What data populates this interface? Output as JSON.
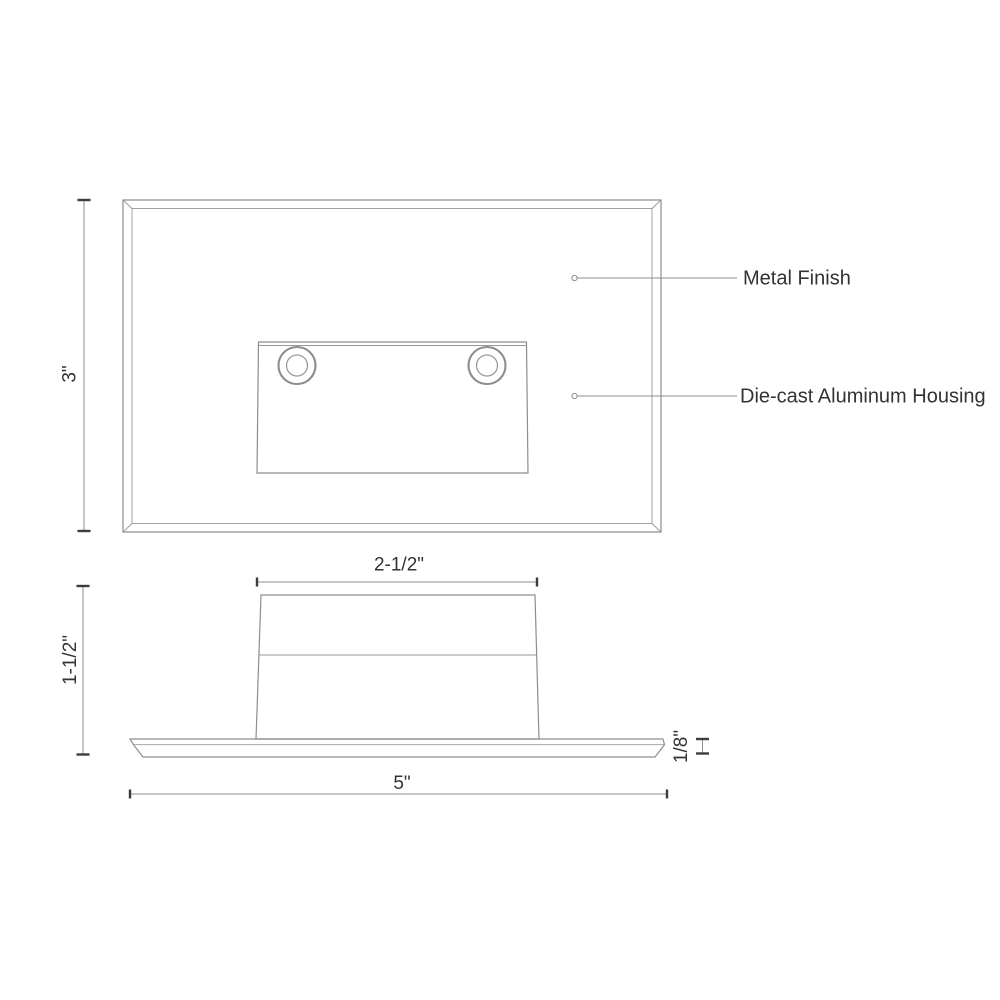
{
  "title": "Step light technical dimension drawing",
  "colors": {
    "background": "#ffffff",
    "drawing_line": "#8d8d8d",
    "tick": "#3c3c3c",
    "text": "#333333"
  },
  "front_view": {
    "height_dimension": "3\"",
    "callouts": [
      {
        "label": "Metal Finish"
      },
      {
        "label": "Die-cast Aluminum Housing"
      }
    ]
  },
  "side_view": {
    "faceplate_width_dimension": "2-1/2\"",
    "height_dimension": "1-1/2\"",
    "plate_thickness_dimension": "1/8\"",
    "overall_width_dimension": "5\""
  }
}
